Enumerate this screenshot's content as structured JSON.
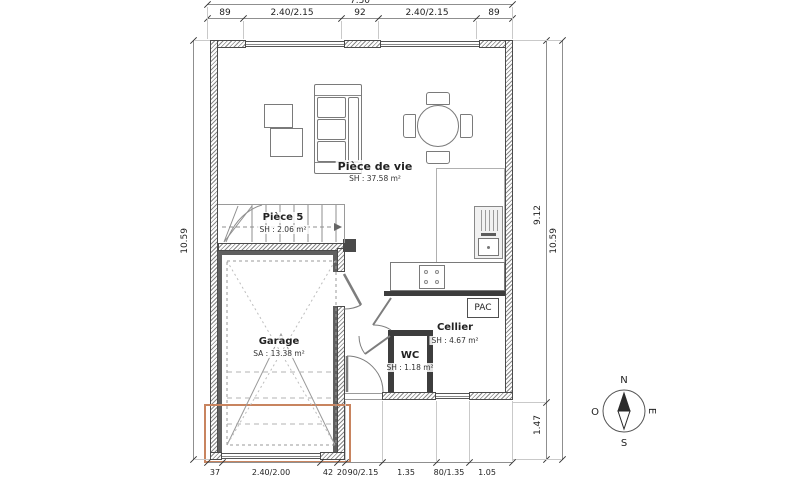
{
  "plan": {
    "rooms": {
      "living": {
        "name": "Pièce de vie",
        "area": "SH : 37.58 m²"
      },
      "room5": {
        "name": "Pièce 5",
        "area": "SH : 2.06 m²"
      },
      "garage": {
        "name": "Garage",
        "area": "SA : 13.38 m²"
      },
      "cellier": {
        "name": "Cellier",
        "area": "SH : 4.67 m²"
      },
      "wc": {
        "name": "WC",
        "area": "SH : 1.18 m²"
      }
    },
    "equipment": {
      "heat_pump": "PAC"
    },
    "dims": {
      "top_total": "7.50",
      "top": [
        "89",
        "2.40/2.15",
        "92",
        "2.40/2.15",
        "89"
      ],
      "left_total": "10.59",
      "right_upper": "9.12",
      "right_lower": "1.47",
      "right_total": "10.59",
      "bottom": [
        "37",
        "2.40/2.00",
        "42",
        "20",
        "90/2.15",
        "1.35",
        "80/1.35",
        "1.05"
      ]
    },
    "compass": {
      "north": "N",
      "east": "E",
      "south": "S",
      "west": "O"
    },
    "colors": {
      "annotation_outline": "#c8845f",
      "wall_fill_dark": "#3d3d3d",
      "hatch_gray": "#8a8a8a"
    }
  }
}
